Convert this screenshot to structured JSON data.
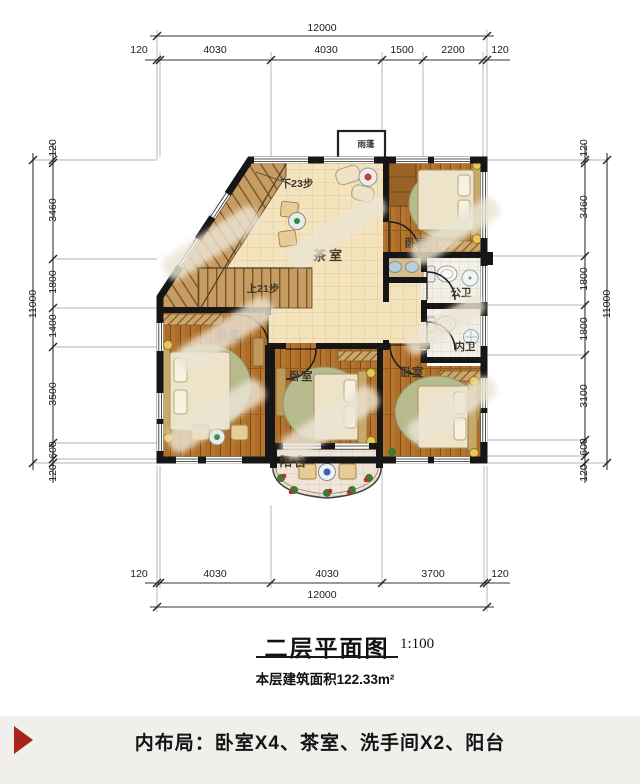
{
  "dims": {
    "top_total": "12000",
    "top_segments": [
      "120",
      "4030",
      "4030",
      "1500",
      "2200",
      "120"
    ],
    "bottom_total": "12000",
    "bottom_segments": [
      "120",
      "4030",
      "4030",
      "3700",
      "120"
    ],
    "left_total": "11000",
    "left_segments": [
      "120",
      "3460",
      "1800",
      "1400",
      "3500",
      "600",
      "120"
    ],
    "right_total": "11000",
    "right_segments": [
      "120",
      "3460",
      "1800",
      "1800",
      "3100",
      "600",
      "120"
    ]
  },
  "rooms": {
    "tea_room": "茶室",
    "bedroom": "卧室",
    "public_bath": "公卫",
    "private_bath": "内卫",
    "balcony": "阳台",
    "rain_canopy": "雨蓬"
  },
  "stairs": {
    "down_label": "下23步",
    "up_label": "上21步"
  },
  "title_block": {
    "title": "二层平面图",
    "scale": "1:100",
    "area_note": "本层建筑面积122.33m²"
  },
  "footer": {
    "text": "内布局：卧室X4、茶室、洗手间X2、阳台"
  },
  "colors": {
    "wall": "#161616",
    "wood_floor": "#ae6d2b",
    "tile_floor": "#f4e4bd",
    "accent_red": "#a8241b"
  }
}
